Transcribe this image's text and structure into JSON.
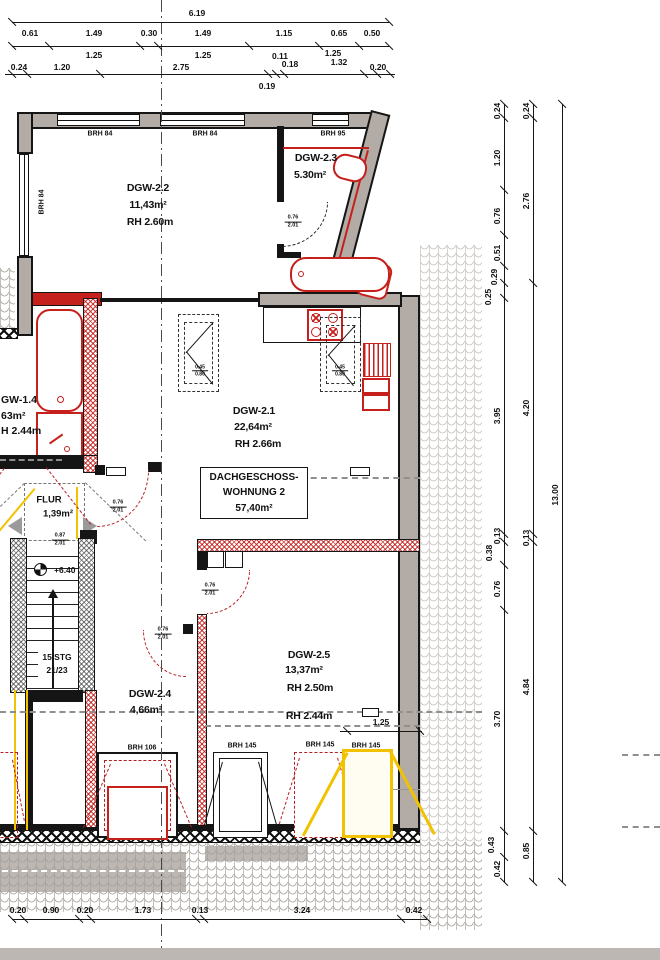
{
  "title_box": {
    "l1": "DACHGESCHOSS-",
    "l2": "WOHNUNG 2",
    "l3": "57,40m²"
  },
  "colors": {
    "red": "#c5201c",
    "dark_red": "#b41f24",
    "yellow": "#f2c200",
    "wall_gray": "#b3aca6",
    "line": "#151515"
  },
  "dim_chains": {
    "top_total": "6.19",
    "top_row2": [
      "0.61",
      "1.49",
      "0.30",
      "1.49",
      "1.15",
      "0.65",
      "0.50"
    ],
    "top_sub": [
      "1.25",
      "1.25",
      "0.11",
      "0.18",
      "1.25",
      "1.32",
      "0.19"
    ],
    "top_row3": [
      "0.24",
      "1.20",
      "2.75",
      "0.20"
    ],
    "right_inner": [
      "0.24",
      "1.20",
      "0.76",
      "0.51",
      "0.29",
      "0.25",
      "3.95",
      "0.13",
      "0.38",
      "0.76",
      "3.70",
      "0.43",
      "0.42"
    ],
    "right_middle": [
      "0.24",
      "2.76",
      "4.20",
      "0.13",
      "4.84",
      "0.85"
    ],
    "right_total": "13.00",
    "bottom": [
      "0.20",
      "0.90",
      "0.20",
      "1.73",
      "0.13",
      "3.24",
      "0.42"
    ],
    "window_width": "1.25"
  },
  "plan_labels": [
    {
      "n": "window-label-top-1",
      "t": "BRH 84",
      "x": 100,
      "y": 134,
      "c": "brh"
    },
    {
      "n": "window-label-top-2",
      "t": "BRH 84",
      "x": 205,
      "y": 134,
      "c": "brh"
    },
    {
      "n": "window-label-top-3",
      "t": "BRH 95",
      "x": 333,
      "y": 134,
      "c": "brh"
    },
    {
      "n": "window-label-left",
      "t": "BRH 84",
      "x": 42,
      "y": 202,
      "c": "brhv"
    },
    {
      "n": "room-dgw22-name",
      "t": "DGW-2.2",
      "x": 148,
      "y": 188,
      "c": "room"
    },
    {
      "n": "room-dgw22-area",
      "t": "11,43m²",
      "x": 148,
      "y": 205,
      "c": "room"
    },
    {
      "n": "room-dgw22-height",
      "t": "RH 2.60m",
      "x": 150,
      "y": 222,
      "c": "room"
    },
    {
      "n": "room-dgw23-name",
      "t": "DGW-2.3",
      "x": 316,
      "y": 158,
      "c": "room"
    },
    {
      "n": "room-dgw23-area",
      "t": "5.30m²",
      "x": 310,
      "y": 175,
      "c": "room"
    },
    {
      "n": "room-dgw21-name",
      "t": "DGW-2.1",
      "x": 254,
      "y": 411,
      "c": "room"
    },
    {
      "n": "room-dgw21-area",
      "t": "22,64m²",
      "x": 253,
      "y": 427,
      "c": "room"
    },
    {
      "n": "room-dgw21-height",
      "t": "RH 2.66m",
      "x": 258,
      "y": 444,
      "c": "room"
    },
    {
      "n": "room-dgw14-name",
      "t": "GW-1.4",
      "x": 1,
      "y": 400,
      "c": "rooml"
    },
    {
      "n": "room-dgw14-area",
      "t": "63m²",
      "x": 1,
      "y": 416,
      "c": "rooml"
    },
    {
      "n": "room-dgw14-height",
      "t": "H 2.44m",
      "x": 1,
      "y": 431,
      "c": "rooml"
    },
    {
      "n": "room-flur-name",
      "t": "FLUR",
      "x": 49,
      "y": 500,
      "c": "rooms"
    },
    {
      "n": "room-flur-area",
      "t": "1,39m²",
      "x": 58,
      "y": 514,
      "c": "rooms"
    },
    {
      "n": "level-marker-text",
      "t": "+6.40",
      "x": 54,
      "y": 570,
      "c": "small9l"
    },
    {
      "n": "stairs-count",
      "t": "15 STG",
      "x": 57,
      "y": 657,
      "c": "small9"
    },
    {
      "n": "stairs-ratio",
      "t": "21/23",
      "x": 57,
      "y": 670,
      "c": "small9"
    },
    {
      "n": "room-dgw24-name",
      "t": "DGW-2.4",
      "x": 150,
      "y": 694,
      "c": "room"
    },
    {
      "n": "room-dgw24-area",
      "t": "4,66m²",
      "x": 146,
      "y": 710,
      "c": "room"
    },
    {
      "n": "room-dgw25-name",
      "t": "DGW-2.5",
      "x": 309,
      "y": 655,
      "c": "room"
    },
    {
      "n": "room-dgw25-area",
      "t": "13,37m²",
      "x": 304,
      "y": 670,
      "c": "room"
    },
    {
      "n": "room-dgw25-height",
      "t": "RH 2.50m",
      "x": 310,
      "y": 688,
      "c": "room"
    },
    {
      "n": "room-dgw25-height2",
      "t": "RH 2.44m",
      "x": 309,
      "y": 716,
      "c": "room"
    },
    {
      "n": "window-label-bottom-1",
      "t": "BRH 106",
      "x": 142,
      "y": 748,
      "c": "brh"
    },
    {
      "n": "window-label-bottom-2",
      "t": "BRH 145",
      "x": 242,
      "y": 746,
      "c": "brh"
    },
    {
      "n": "window-label-bottom-3",
      "t": "BRH 145",
      "x": 320,
      "y": 745,
      "c": "brh"
    },
    {
      "n": "window-label-bottom-4",
      "t": "BRH 145",
      "x": 366,
      "y": 746,
      "c": "brh"
    }
  ],
  "dim_labels": [
    {
      "t": "6.19",
      "x": 197,
      "y": 13,
      "c": "dim"
    },
    {
      "t": "0.61",
      "x": 30,
      "y": 33,
      "c": "dim"
    },
    {
      "t": "1.49",
      "x": 94,
      "y": 33,
      "c": "dim"
    },
    {
      "t": "0.30",
      "x": 149,
      "y": 33,
      "c": "dim"
    },
    {
      "t": "1.49",
      "x": 203,
      "y": 33,
      "c": "dim"
    },
    {
      "t": "1.15",
      "x": 284,
      "y": 33,
      "c": "dim"
    },
    {
      "t": "0.65",
      "x": 339,
      "y": 33,
      "c": "dim"
    },
    {
      "t": "0.50",
      "x": 372,
      "y": 33,
      "c": "dim"
    },
    {
      "t": "1.25",
      "x": 94,
      "y": 55,
      "c": "dim"
    },
    {
      "t": "1.25",
      "x": 203,
      "y": 55,
      "c": "dim"
    },
    {
      "t": "0.11",
      "x": 280,
      "y": 56,
      "c": "dim"
    },
    {
      "t": "0.18",
      "x": 290,
      "y": 64,
      "c": "dim"
    },
    {
      "t": "1.25",
      "x": 333,
      "y": 53,
      "c": "dim"
    },
    {
      "t": "1.32",
      "x": 339,
      "y": 62,
      "c": "dim"
    },
    {
      "t": "0.24",
      "x": 19,
      "y": 67,
      "c": "dim"
    },
    {
      "t": "1.20",
      "x": 62,
      "y": 67,
      "c": "dim"
    },
    {
      "t": "2.75",
      "x": 181,
      "y": 67,
      "c": "dim"
    },
    {
      "t": "0.20",
      "x": 378,
      "y": 67,
      "c": "dim"
    },
    {
      "t": "0.19",
      "x": 267,
      "y": 86,
      "c": "dim"
    },
    {
      "t": "0.20",
      "x": 18,
      "y": 910,
      "c": "dim"
    },
    {
      "t": "0.90",
      "x": 51,
      "y": 910,
      "c": "dim"
    },
    {
      "t": "0.20",
      "x": 85,
      "y": 910,
      "c": "dim"
    },
    {
      "t": "1.73",
      "x": 143,
      "y": 910,
      "c": "dim"
    },
    {
      "t": "0.13",
      "x": 200,
      "y": 910,
      "c": "dim"
    },
    {
      "t": "3.24",
      "x": 302,
      "y": 910,
      "c": "dim"
    },
    {
      "t": "0.42",
      "x": 414,
      "y": 910,
      "c": "dim"
    },
    {
      "t": "1.25",
      "x": 381,
      "y": 722,
      "c": "dim"
    },
    {
      "t": "0.24",
      "x": 497,
      "y": 111,
      "c": "dimv"
    },
    {
      "t": "1.20",
      "x": 497,
      "y": 158,
      "c": "dimv"
    },
    {
      "t": "0.76",
      "x": 497,
      "y": 216,
      "c": "dimv"
    },
    {
      "t": "0.51",
      "x": 497,
      "y": 253,
      "c": "dimv"
    },
    {
      "t": "0.29",
      "x": 494,
      "y": 277,
      "c": "dimv"
    },
    {
      "t": "0.25",
      "x": 488,
      "y": 297,
      "c": "dimv"
    },
    {
      "t": "3.95",
      "x": 497,
      "y": 416,
      "c": "dimv"
    },
    {
      "t": "0.13",
      "x": 497,
      "y": 536,
      "c": "dimv"
    },
    {
      "t": "0.38",
      "x": 489,
      "y": 553,
      "c": "dimv"
    },
    {
      "t": "0.76",
      "x": 497,
      "y": 589,
      "c": "dimv"
    },
    {
      "t": "3.70",
      "x": 497,
      "y": 719,
      "c": "dimv"
    },
    {
      "t": "0.43",
      "x": 491,
      "y": 845,
      "c": "dimv"
    },
    {
      "t": "0.42",
      "x": 497,
      "y": 869,
      "c": "dimv"
    },
    {
      "t": "0.24",
      "x": 526,
      "y": 111,
      "c": "dimv"
    },
    {
      "t": "2.76",
      "x": 526,
      "y": 201,
      "c": "dimv"
    },
    {
      "t": "4.20",
      "x": 526,
      "y": 408,
      "c": "dimv"
    },
    {
      "t": "0.13",
      "x": 526,
      "y": 538,
      "c": "dimv"
    },
    {
      "t": "4.84",
      "x": 526,
      "y": 687,
      "c": "dimv"
    },
    {
      "t": "0.85",
      "x": 526,
      "y": 851,
      "c": "dimv"
    },
    {
      "t": "13.00",
      "x": 555,
      "y": 495,
      "c": "dimv"
    }
  ],
  "frac_labels": [
    {
      "n": "door-size-bath",
      "a": "0.76",
      "b": "2.01",
      "x": 293,
      "y": 222
    },
    {
      "n": "door-size-flur-right",
      "a": "0.76",
      "b": "2.01",
      "x": 118,
      "y": 507
    },
    {
      "n": "door-size-flur-bottom",
      "a": "0.87",
      "b": "2.01",
      "x": 60,
      "y": 540
    },
    {
      "n": "door-size-dgw25",
      "a": "0.76",
      "b": "2.01",
      "x": 210,
      "y": 590
    },
    {
      "n": "door-size-dgw24",
      "a": "0.76",
      "b": "2.01",
      "x": 163,
      "y": 634
    },
    {
      "n": "skylight-size-1",
      "a": "0.45",
      "b": "0.80",
      "x": 200,
      "y": 371,
      "tiny": true
    },
    {
      "n": "skylight-size-2",
      "a": "0.45",
      "b": "0.80",
      "x": 340,
      "y": 371,
      "tiny": true
    }
  ]
}
